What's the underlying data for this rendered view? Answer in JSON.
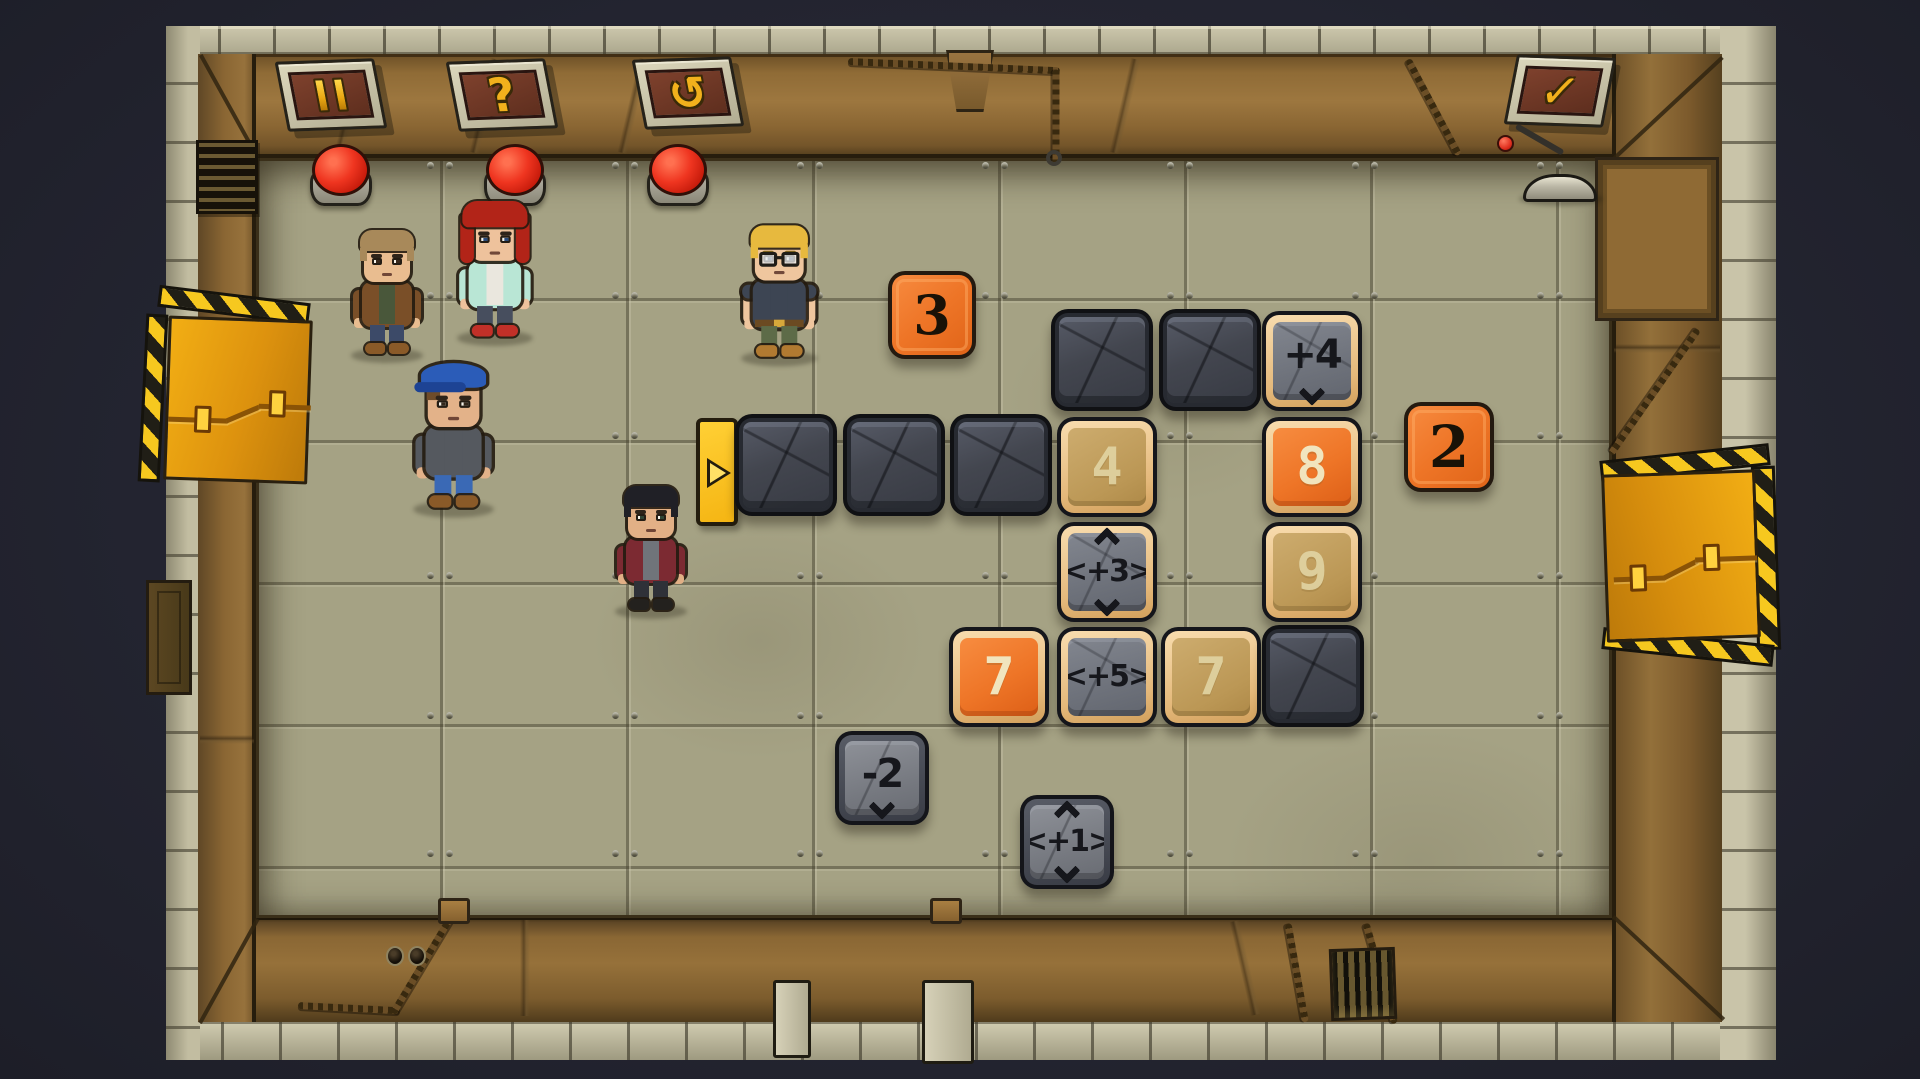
{
  "scene": {
    "width": 1920,
    "height": 1079
  },
  "palette": {
    "background": "#232430",
    "wall_wood": "#8a6836",
    "wall_stone": "#bcb79c",
    "floor": "#a5a284",
    "accent_gold": "#f2b11c",
    "button_red": "#ef3520",
    "tile_orange": "#ee7527",
    "tile_tan": "#bb9755",
    "tile_stone": "#43464f",
    "hazard_yellow": "#f6c81f",
    "door_orange": "#dd920e",
    "marker_yellow": "#f5b513"
  },
  "toolbar": {
    "pause_button": {
      "icon": "pause-bars"
    },
    "help_button": {
      "glyph": "?"
    },
    "restart_button": {
      "glyph": "↺"
    },
    "confirm_button": {
      "glyph": "✓"
    }
  },
  "wall_buttons": [
    {
      "id": "wall-button-1",
      "cx": 341,
      "cy": 175
    },
    {
      "id": "wall-button-2",
      "cx": 515,
      "cy": 175
    },
    {
      "id": "wall-button-3",
      "cx": 678,
      "cy": 175
    }
  ],
  "lever": {
    "x": 1548,
    "y": 178,
    "ball_color": "#e63424"
  },
  "spawn_marker": {
    "x": 696,
    "y": 418,
    "direction": "right"
  },
  "tiles": [
    {
      "name": "tile-3",
      "kind": "free",
      "label": "3",
      "arrows": "none",
      "x": 888,
      "y": 271,
      "size": 88
    },
    {
      "name": "tile-2",
      "kind": "free",
      "label": "2",
      "arrows": "none",
      "x": 1404,
      "y": 402,
      "size": 90
    },
    {
      "name": "block-1",
      "kind": "stone",
      "label": "",
      "arrows": "none",
      "x": 1051,
      "y": 309,
      "size": 102
    },
    {
      "name": "block-2",
      "kind": "stone",
      "label": "",
      "arrows": "none",
      "x": 1159,
      "y": 309,
      "size": 102
    },
    {
      "name": "tile-plus4",
      "kind": "mtan",
      "label": "+4",
      "arrows": "down",
      "x": 1262,
      "y": 311,
      "size": 100
    },
    {
      "name": "block-3",
      "kind": "stone",
      "label": "",
      "arrows": "none",
      "x": 735,
      "y": 414,
      "size": 102
    },
    {
      "name": "block-4",
      "kind": "stone",
      "label": "",
      "arrows": "none",
      "x": 843,
      "y": 414,
      "size": 102
    },
    {
      "name": "block-5",
      "kind": "stone",
      "label": "",
      "arrows": "none",
      "x": 950,
      "y": 414,
      "size": 102
    },
    {
      "name": "tile-4",
      "kind": "ntan",
      "label": "4",
      "arrows": "none",
      "x": 1057,
      "y": 417,
      "size": 100
    },
    {
      "name": "tile-8",
      "kind": "norange",
      "label": "8",
      "arrows": "none",
      "x": 1262,
      "y": 417,
      "size": 100
    },
    {
      "name": "tile-plus3",
      "kind": "mtan",
      "label": "<+3>",
      "arrows": "updown",
      "x": 1057,
      "y": 522,
      "size": 100
    },
    {
      "name": "tile-9",
      "kind": "ntan",
      "label": "9",
      "arrows": "none",
      "x": 1262,
      "y": 522,
      "size": 100
    },
    {
      "name": "tile-7-orange",
      "kind": "norange",
      "label": "7",
      "arrows": "none",
      "x": 949,
      "y": 627,
      "size": 100
    },
    {
      "name": "tile-plus5",
      "kind": "mtan",
      "label": "<+5>",
      "arrows": "none",
      "x": 1057,
      "y": 627,
      "size": 100
    },
    {
      "name": "tile-7-tan",
      "kind": "ntan",
      "label": "7",
      "arrows": "none",
      "x": 1161,
      "y": 627,
      "size": 100
    },
    {
      "name": "block-6",
      "kind": "stone",
      "label": "",
      "arrows": "none",
      "x": 1262,
      "y": 625,
      "size": 102
    },
    {
      "name": "tile-minus2",
      "kind": "mdark",
      "label": "-2",
      "arrows": "down",
      "x": 835,
      "y": 731,
      "size": 94
    },
    {
      "name": "tile-plus1",
      "kind": "mdark",
      "label": "<+1>",
      "arrows": "updown",
      "x": 1020,
      "y": 795,
      "size": 94
    }
  ],
  "characters": [
    {
      "name": "man-brown-jacket",
      "x": 349,
      "y": 224,
      "scale": 1.0,
      "colors": {
        "skin": "#e9bd90",
        "hair": "#a8895a",
        "top": "#7a4f28",
        "shirt": "#49573a",
        "pants": "#3c4a68",
        "shoes": "#8a5a28",
        "iris": "#3a2a1c"
      }
    },
    {
      "name": "woman-red-hair",
      "x": 455,
      "y": 200,
      "scale": 1.05,
      "female": true,
      "colors": {
        "skin": "#eec29c",
        "hair": "#b22418",
        "top": "#b9e6d5",
        "shirt": "#eae7de",
        "pants": "#474e5e",
        "shoes": "#c23028",
        "iris": "#2a4a7a"
      }
    },
    {
      "name": "man-blue-cap",
      "x": 411,
      "y": 362,
      "scale": 1.12,
      "cap": true,
      "colors": {
        "skin": "#e3b289",
        "hair": "#6e4c2a",
        "top": "#55595f",
        "shirt": "#55595f",
        "pants": "#3a69b5",
        "shoes": "#8a5a28",
        "iris": "#33281c",
        "capColor": "#2b5cb8",
        "capDark": "#1d4394"
      }
    },
    {
      "name": "man-red-jacket",
      "x": 613,
      "y": 480,
      "scale": 1.0,
      "colors": {
        "skin": "#e2b086",
        "hair": "#202026",
        "top": "#7c2a32",
        "shirt": "#70747a",
        "pants": "#2f3138",
        "shoes": "#23211e",
        "iris": "#2f4434"
      }
    },
    {
      "name": "man-blonde-glasses",
      "x": 739,
      "y": 219,
      "scale": 1.06,
      "glasses": true,
      "shortSleeves": true,
      "belt": true,
      "brow": "#8a6b1e",
      "colors": {
        "skin": "#efc69e",
        "hair": "#e7b93e",
        "top": "#3d4553",
        "shirt": "#3d4553",
        "pants": "#5d6b48",
        "shoes": "#b17a31",
        "iris": "#2a3a50"
      }
    }
  ]
}
